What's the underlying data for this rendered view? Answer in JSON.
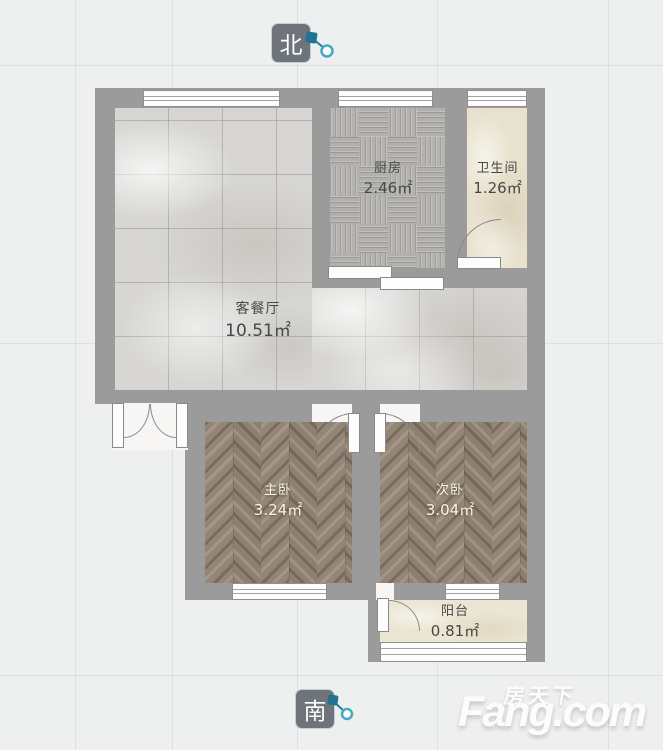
{
  "compass": {
    "north_label": "北",
    "south_label": "南",
    "pin_color": "#227e9b"
  },
  "rooms": [
    {
      "id": "kitchen",
      "name": "厨房",
      "area": "2.46㎡"
    },
    {
      "id": "bathroom",
      "name": "卫生间",
      "area": "1.26㎡"
    },
    {
      "id": "living_dining",
      "name": "客餐厅",
      "area": "10.51㎡"
    },
    {
      "id": "master_bedroom",
      "name": "主卧",
      "area": "3.24㎡"
    },
    {
      "id": "second_bedroom",
      "name": "次卧",
      "area": "3.04㎡"
    },
    {
      "id": "balcony",
      "name": "阳台",
      "area": "0.81㎡"
    }
  ],
  "watermark": {
    "cn": "房天下",
    "en": "Fang.com"
  },
  "colors": {
    "wall": "#9b9b9b",
    "background": "#eef0ef",
    "badge": "#6e747a"
  }
}
